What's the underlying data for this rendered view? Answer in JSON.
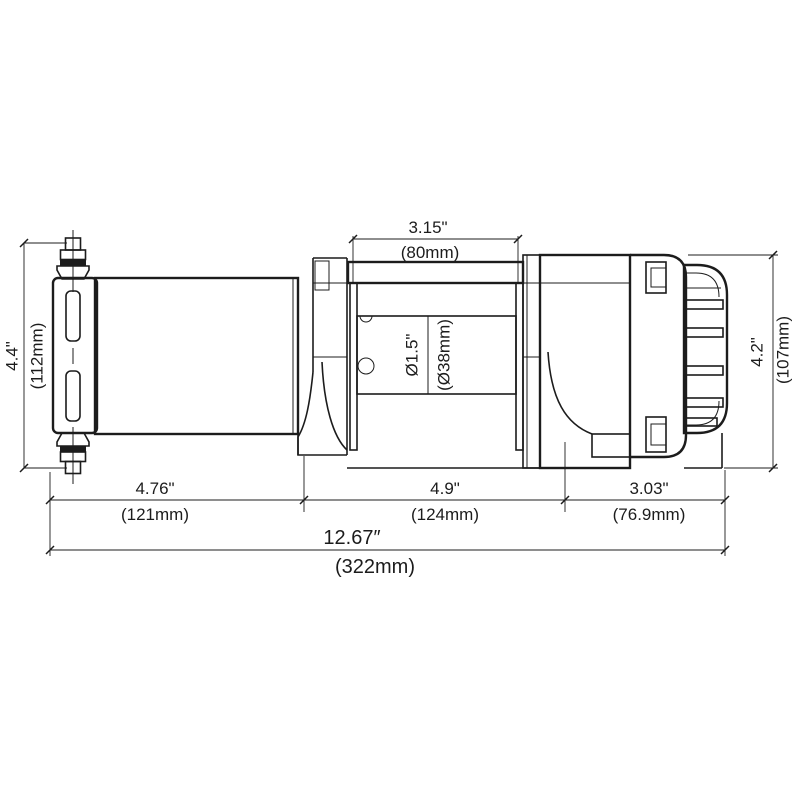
{
  "page": {
    "background": "#ffffff",
    "line_color": "#1c1c1c"
  },
  "drawing": {
    "kind": "winch-dimension-drawing",
    "dims": {
      "top": {
        "in": "3.15\"",
        "mm": "(80mm)"
      },
      "left": {
        "in": "4.4\"",
        "mm": "(112mm)"
      },
      "right": {
        "in": "4.2\"",
        "mm": "(107mm)"
      },
      "drum": {
        "in": "Ø1.5\"",
        "mm": "(Ø38mm)"
      },
      "bottom_left": {
        "in": "4.76\"",
        "mm": "(121mm)"
      },
      "bottom_mid": {
        "in": "4.9\"",
        "mm": "(124mm)"
      },
      "bottom_right": {
        "in": "3.03\"",
        "mm": "(76.9mm)"
      },
      "overall": {
        "in": "12.67″",
        "mm": "(322mm)"
      }
    }
  }
}
